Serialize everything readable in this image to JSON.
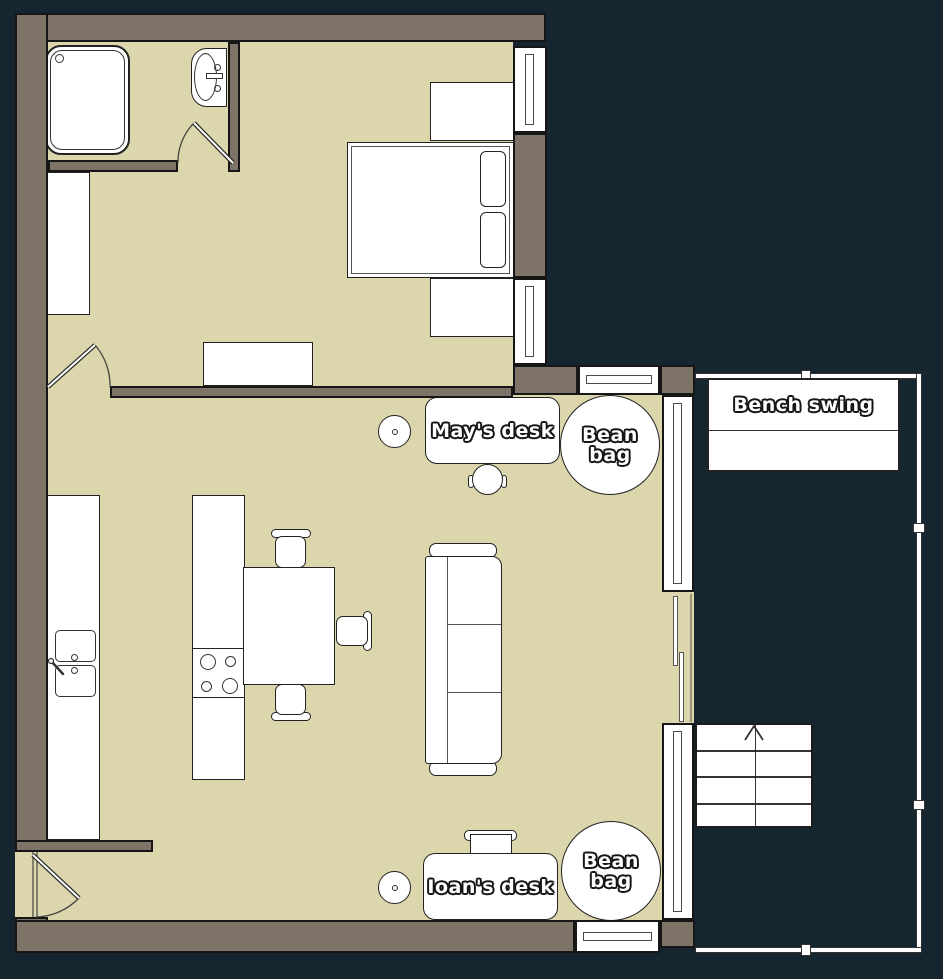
{
  "canvas": {
    "width": 943,
    "height": 979
  },
  "colors": {
    "background": "#152631",
    "wall_fill": "#7d7467",
    "wall_outline": "#161616",
    "floor_fill": "#dcd6ac",
    "object_fill": "#ffffff",
    "object_outline": "#1f1f1f",
    "label_text": "#ffffff",
    "label_outline": "#161616"
  },
  "labels": {
    "desk_top": "May's desk",
    "bean_bag_top": "Bean bag",
    "bench_swing": "Bench swing",
    "desk_bottom": "Ioan's desk",
    "bean_bag_bottom": "Bean bag"
  }
}
